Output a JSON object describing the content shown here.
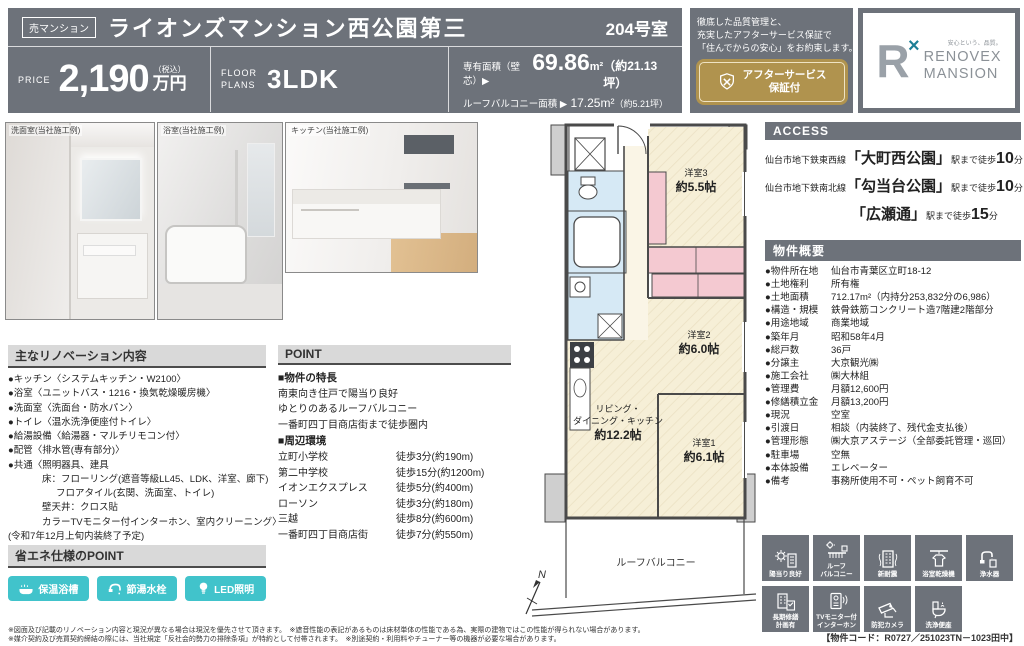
{
  "colors": {
    "header_gray": "#6d727a",
    "accent_gold": "#b0934e",
    "accent_teal": "#41c3cb"
  },
  "header": {
    "badge": "売マンション",
    "title": "ライオンズマンション西公園第三",
    "room_no": "204号室",
    "price_label": "PRICE",
    "price_value": "2,190",
    "price_tax": "（税込）",
    "price_unit": "万円",
    "plan_label_1": "FLOOR",
    "plan_label_2": "PLANS",
    "plan_value": "3LDK",
    "area_label": "専有面積（壁芯）▶",
    "area_value": "69.86",
    "area_unit": "m²",
    "area_tsubo": "（約21.13坪）",
    "balcony_label": "ルーフバルコニー面積 ▶",
    "balcony_value": "17.25m²",
    "balcony_tsubo": "（約5.21坪）",
    "promo_line1": "徹底した品質管理と、",
    "promo_line2": "充実したアフターサービス保証で",
    "promo_line3": "「住んでからの安心」をお約束します。",
    "gold_line1": "アフターサービス",
    "gold_line2": "保証付",
    "logo_r": "R",
    "logo_x": "×",
    "logo_tagline": "安心という、品質。",
    "logo_name1": "RENOVEX",
    "logo_name2": "MANSION"
  },
  "photos": {
    "captions": [
      "洗面室(当社施工例)",
      "浴室(当社施工例)",
      "キッチン(当社施工例)"
    ]
  },
  "renovation": {
    "header": "主なリノベーション内容",
    "items": [
      {
        "t": "●キッチン〈システムキッチン・W2100〉"
      },
      {
        "t": "●浴室〈ユニットバス・1216・換気乾燥暖房機〉"
      },
      {
        "t": "●洗面室〈洗面台・防水パン〉"
      },
      {
        "t": "●トイレ〈温水洗浄便座付トイレ〉"
      },
      {
        "t": "●給湯設備〈給湯器・マルチリモコン付〉"
      },
      {
        "t": "●配管〈排水管(専有部分)〉"
      },
      {
        "t": "●共通〈照明器具、建具"
      },
      {
        "t": "床：フローリング(遮音等級LL45、LDK、洋室、廊下)"
      },
      {
        "t": "フロアタイル(玄関、洗面室、トイレ)"
      },
      {
        "t": "壁天井：クロス貼"
      },
      {
        "t": "カラーTVモニター付インターホン、室内クリーニング〉"
      },
      {
        "t": "(令和7年12月上旬内装終了予定)"
      }
    ]
  },
  "eco": {
    "header": "省エネ仕様のPOINT",
    "items": [
      {
        "label": "保温浴槽"
      },
      {
        "label": "節湯水栓"
      },
      {
        "label": "LED照明"
      }
    ]
  },
  "point": {
    "header": "POINT",
    "feature_title": "■物件の特長",
    "features": [
      "南東向き住戸で陽当り良好",
      "ゆとりのあるルーフバルコニー",
      "一番町四丁目商店街まで徒歩圏内"
    ],
    "env_title": "■周辺環境",
    "env": [
      {
        "n": "立町小学校",
        "d": "徒歩3分(約190m)"
      },
      {
        "n": "第二中学校",
        "d": "徒歩15分(約1200m)"
      },
      {
        "n": "イオンエクスプレス",
        "d": "徒歩5分(約400m)"
      },
      {
        "n": "ローソン",
        "d": "徒歩3分(約180m)"
      },
      {
        "n": "三越",
        "d": "徒歩8分(約600m)"
      },
      {
        "n": "一番町四丁目商店街",
        "d": "徒歩7分(約550m)"
      }
    ]
  },
  "floorplan": {
    "room3_name": "洋室3",
    "room3_size": "約5.5帖",
    "room2_name": "洋室2",
    "room2_size": "約6.0帖",
    "room1_name": "洋室1",
    "room1_size": "約6.1帖",
    "ldk_line1": "リビング・",
    "ldk_line2": "ダイニング・キッチン",
    "ldk_size": "約12.2帖",
    "balcony": "ルーフバルコニー",
    "compass": "N"
  },
  "access": {
    "header": "ACCESS",
    "lines": [
      {
        "pre": "仙台市地下鉄東西線",
        "sta": "「大町西公園」",
        "mid": "駅まで徒歩",
        "num": "10",
        "suf": "分"
      },
      {
        "pre": "仙台市地下鉄南北線",
        "sta": "「勾当台公園」",
        "mid": "駅まで徒歩",
        "num": "10",
        "suf": "分"
      },
      {
        "pre": "",
        "sta": "「広瀬通」",
        "mid": "駅まで徒歩",
        "num": "15",
        "suf": "分"
      }
    ]
  },
  "overview": {
    "header": "物件概要",
    "rows": [
      {
        "l": "●物件所在地",
        "v": "仙台市青葉区立町18-12"
      },
      {
        "l": "●土地権利",
        "v": "所有権"
      },
      {
        "l": "●土地面積",
        "v": "712.17m²（内持分253,832分の6,986）"
      },
      {
        "l": "●構造・規模",
        "v": "鉄骨鉄筋コンクリート造7階建2階部分"
      },
      {
        "l": "●用途地域",
        "v": "商業地域"
      },
      {
        "l": "●築年月",
        "v": "昭和58年4月"
      },
      {
        "l": "●総戸数",
        "v": "36戸"
      },
      {
        "l": "●分譲主",
        "v": "大京観光㈱"
      },
      {
        "l": "●施工会社",
        "v": "㈱大林組"
      },
      {
        "l": "●管理費",
        "v": "月額12,600円"
      },
      {
        "l": "●修繕積立金",
        "v": "月額13,200円"
      },
      {
        "l": "●現況",
        "v": "空室"
      },
      {
        "l": "●引渡日",
        "v": "相談（内装終了、残代金支払後）"
      },
      {
        "l": "●管理形態",
        "v": "㈱大京アステージ（全部委託管理・巡回）"
      },
      {
        "l": "●駐車場",
        "v": "空無"
      },
      {
        "l": "●本体設備",
        "v": "エレベーター"
      },
      {
        "l": "●備考",
        "v": "事務所使用不可・ペット飼育不可"
      }
    ]
  },
  "icons": {
    "row1": [
      {
        "label": "陽当り良好"
      },
      {
        "label": "ルーフ\nバルコニー"
      },
      {
        "label": "新耐震"
      },
      {
        "label": "浴室乾燥機"
      },
      {
        "label": "浄水器"
      }
    ],
    "row2": [
      {
        "label": "長期修繕\n計画有"
      },
      {
        "label": "TVモニター付\nインターホン"
      },
      {
        "label": "防犯カメラ"
      },
      {
        "label": "洗浄便座"
      }
    ]
  },
  "property_code": "【物件コード：R0727／251023TN－1023田中】",
  "disclaimer": {
    "line1": "※図面及び記載のリノベーション内容と現況が異なる場合は現況を優先させて頂きます。　※遮音性能の表記があるものは床材単体の性能である為、実際の建物ではこの性能が得られない場合があります。",
    "line2": "※媒介契約及び売買契約締結の際には、当社規定「反社会的勢力の排除条項」が特約として付帯されます。　※別途契約・利用料やチューナー等の機器が必要な場合があります。"
  }
}
